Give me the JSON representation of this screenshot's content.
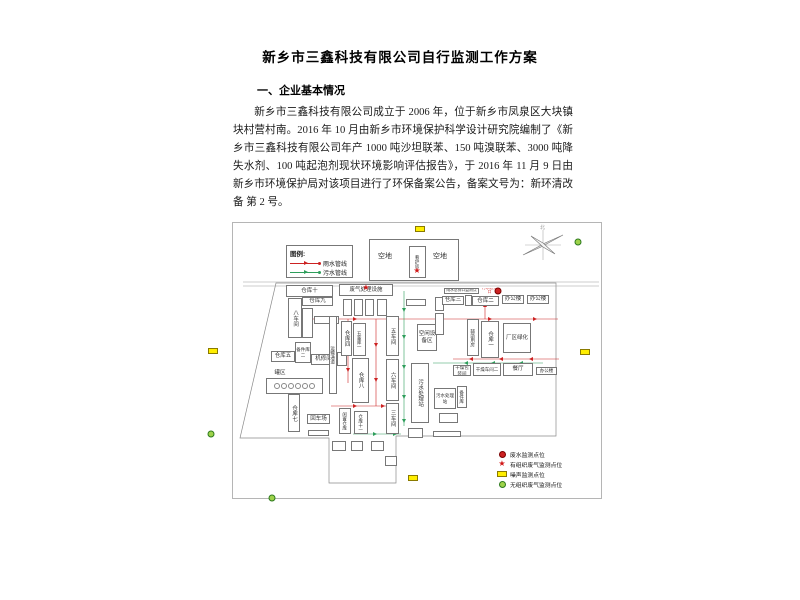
{
  "document": {
    "title": "新乡市三鑫科技有限公司自行监测工作方案",
    "section1_heading": "一、企业基本情况",
    "section1_paragraph": "新乡市三鑫科技有限公司成立于 2006 年，位于新乡市凤泉区大块镇块村营村南。2016 年 10 月由新乡市环境保护科学设计研究院编制了《新乡市三鑫科技有限公司年产 1000 吨沙坦联苯、150 吨溴联苯、3000 吨降失水剂、100 吨起泡剂现状环境影响评估报告》，于 2016 年 11 月 9 日由新乡市环境保护局对该项目进行了环保备案公告，备案文号为：新环清改备 第 2 号。",
    "section2_heading": "二、监测点位及示意图"
  },
  "diagram": {
    "compass_label": "北",
    "colors": {
      "rain": "#cc2222",
      "sewage": "#2e9e5b",
      "noise_fill": "#ffee00",
      "gas_green": "#9ed24a"
    },
    "legend_pipes": {
      "title": "图例:",
      "items": [
        {
          "label": "雨水管线",
          "color": "#cc2222"
        },
        {
          "label": "污水管线",
          "color": "#2e9e5b"
        }
      ]
    },
    "legend_points": {
      "items": [
        {
          "label": "废水监测点位",
          "symbol": "red-dot"
        },
        {
          "label": "有组织废气监测点位",
          "symbol": "red-star"
        },
        {
          "label": "噪声监测点位",
          "symbol": "yellow-rect"
        },
        {
          "label": "无组织废气监测点位",
          "symbol": "green-circle"
        }
      ]
    },
    "open_area": {
      "label_left": "空地",
      "label_right": "空地",
      "guard_room": "看护房"
    },
    "buildings": [
      {
        "l": "",
        "x": 136,
        "y": 16,
        "w": 90,
        "h": 42
      },
      {
        "l": "空地",
        "x": 142,
        "y": 28,
        "w": 20,
        "h": 12,
        "nb": 1,
        "big": 1
      },
      {
        "l": "空地",
        "x": 197,
        "y": 28,
        "w": 20,
        "h": 12,
        "nb": 1,
        "big": 1
      },
      {
        "l": "看护房",
        "x": 176,
        "y": 23,
        "w": 17,
        "h": 32,
        "v": 1,
        "small": 1
      },
      {
        "l": "仓库十",
        "x": 53,
        "y": 62,
        "w": 47,
        "h": 12
      },
      {
        "l": "仓库九",
        "x": 69,
        "y": 74,
        "w": 31,
        "h": 9
      },
      {
        "l": "八车间",
        "x": 55,
        "y": 75,
        "w": 14,
        "h": 40,
        "v": 1
      },
      {
        "l": "",
        "x": 69,
        "y": 85,
        "w": 11,
        "h": 30,
        "v": 1
      },
      {
        "l": "",
        "x": 81,
        "y": 93,
        "w": 25,
        "h": 8
      },
      {
        "l": "仓库五",
        "x": 38,
        "y": 128,
        "w": 24,
        "h": 11
      },
      {
        "l": "备件库二",
        "x": 62,
        "y": 119,
        "w": 16,
        "h": 21,
        "small": 1
      },
      {
        "l": "机修间",
        "x": 78,
        "y": 131,
        "w": 25,
        "h": 11
      },
      {
        "l": "",
        "x": 104,
        "y": 129,
        "w": 10,
        "h": 14
      },
      {
        "l": "罐区",
        "x": 38,
        "y": 146,
        "w": 18,
        "h": 8,
        "nb": 1
      },
      {
        "l": "",
        "x": 33,
        "y": 155,
        "w": 57,
        "h": 16,
        "tank": 1
      },
      {
        "l": "仓库七",
        "x": 55,
        "y": 171,
        "w": 12,
        "h": 38,
        "v": 1
      },
      {
        "l": "回车场",
        "x": 74,
        "y": 191,
        "w": 23,
        "h": 10
      },
      {
        "l": "",
        "x": 75,
        "y": 207,
        "w": 21,
        "h": 6
      },
      {
        "l": "运输通道",
        "x": 96,
        "y": 93,
        "w": 8,
        "h": 78,
        "v": 1,
        "small": 1
      },
      {
        "l": "废气处理设施",
        "x": 106,
        "y": 61,
        "w": 54,
        "h": 12
      },
      {
        "l": "",
        "x": 110,
        "y": 76,
        "w": 9,
        "h": 17
      },
      {
        "l": "",
        "x": 121,
        "y": 76,
        "w": 9,
        "h": 17
      },
      {
        "l": "",
        "x": 132,
        "y": 76,
        "w": 9,
        "h": 17
      },
      {
        "l": "",
        "x": 144,
        "y": 76,
        "w": 10,
        "h": 17
      },
      {
        "l": "仓库四",
        "x": 108,
        "y": 98,
        "w": 11,
        "h": 35,
        "v": 1
      },
      {
        "l": "五金库一",
        "x": 120,
        "y": 100,
        "w": 13,
        "h": 33,
        "v": 1,
        "small": 1
      },
      {
        "l": "五车间",
        "x": 153,
        "y": 93,
        "w": 13,
        "h": 40,
        "v": 1
      },
      {
        "l": "六车间",
        "x": 153,
        "y": 136,
        "w": 13,
        "h": 42,
        "v": 1
      },
      {
        "l": "三车间",
        "x": 153,
        "y": 180,
        "w": 13,
        "h": 31,
        "v": 1
      },
      {
        "l": "仓库八",
        "x": 119,
        "y": 135,
        "w": 17,
        "h": 45,
        "v": 1
      },
      {
        "l": "闲置仓库",
        "x": 106,
        "y": 185,
        "w": 12,
        "h": 26,
        "v": 1,
        "small": 1
      },
      {
        "l": "仓库十一",
        "x": 121,
        "y": 188,
        "w": 14,
        "h": 23,
        "v": 1,
        "small": 1
      },
      {
        "l": "污水处理站",
        "x": 178,
        "y": 140,
        "w": 18,
        "h": 60,
        "v": 1
      },
      {
        "l": "空闲设备区",
        "x": 184,
        "y": 101,
        "w": 20,
        "h": 27
      },
      {
        "l": "",
        "x": 173,
        "y": 76,
        "w": 20,
        "h": 7
      },
      {
        "l": "",
        "x": 202,
        "y": 74,
        "w": 9,
        "h": 14,
        "v": 1
      },
      {
        "l": "",
        "x": 202,
        "y": 90,
        "w": 9,
        "h": 22,
        "v": 1
      },
      {
        "l": "",
        "x": 99,
        "y": 218,
        "w": 14,
        "h": 10
      },
      {
        "l": "",
        "x": 118,
        "y": 218,
        "w": 12,
        "h": 10
      },
      {
        "l": "",
        "x": 138,
        "y": 218,
        "w": 13,
        "h": 10
      },
      {
        "l": "",
        "x": 152,
        "y": 233,
        "w": 12,
        "h": 10
      },
      {
        "l": "",
        "x": 175,
        "y": 205,
        "w": 15,
        "h": 10
      },
      {
        "l": "",
        "x": 206,
        "y": 190,
        "w": 19,
        "h": 10
      },
      {
        "l": "",
        "x": 200,
        "y": 208,
        "w": 28,
        "h": 6
      },
      {
        "l": "仓库三",
        "x": 209,
        "y": 73,
        "w": 22,
        "h": 9
      },
      {
        "l": "",
        "x": 232,
        "y": 72,
        "w": 7,
        "h": 11
      },
      {
        "l": "仓库二",
        "x": 239,
        "y": 73,
        "w": 27,
        "h": 10
      },
      {
        "l": "办公楼",
        "x": 269,
        "y": 72,
        "w": 22,
        "h": 9
      },
      {
        "l": "办公楼",
        "x": 294,
        "y": 72,
        "w": 22,
        "h": 9
      },
      {
        "l": "辅助用房",
        "x": 234,
        "y": 96,
        "w": 12,
        "h": 37,
        "v": 1,
        "small": 1
      },
      {
        "l": "仓库一",
        "x": 248,
        "y": 98,
        "w": 18,
        "h": 37,
        "v": 1
      },
      {
        "l": "厂区绿化",
        "x": 270,
        "y": 100,
        "w": 28,
        "h": 30
      },
      {
        "l": "干燥包装间",
        "x": 220,
        "y": 142,
        "w": 18,
        "h": 11,
        "small": 1
      },
      {
        "l": "干燥车间二",
        "x": 240,
        "y": 140,
        "w": 28,
        "h": 13,
        "small": 1
      },
      {
        "l": "餐厅",
        "x": 270,
        "y": 140,
        "w": 30,
        "h": 13
      },
      {
        "l": "办公楼",
        "x": 303,
        "y": 144,
        "w": 21,
        "h": 8,
        "small": 1
      },
      {
        "l": "污水处理站",
        "x": 201,
        "y": 165,
        "w": 22,
        "h": 21,
        "small": 1
      },
      {
        "l": "备件库",
        "x": 224,
        "y": 163,
        "w": 10,
        "h": 22,
        "v": 1,
        "small": 1
      },
      {
        "l": "雨水总排口监测点",
        "x": 211,
        "y": 65,
        "w": 35,
        "h": 6,
        "micro": 1
      },
      {
        "l": "污水总排口",
        "x": 248,
        "y": 65,
        "w": 17,
        "h": 6,
        "micro": 1,
        "red": 1,
        "nb": 1
      }
    ],
    "boundary_points": "43,60 323,60 323,213 163,213 163,260 96,260 96,215 7,215",
    "roads": [
      [
        10,
        59,
        366,
        59
      ],
      [
        10,
        63,
        366,
        63
      ]
    ],
    "pipes": [
      {
        "c": "#cc2222",
        "pts": [
          68,
          96,
          325,
          96
        ],
        "arrows": [
          [
            90,
            96,
            "r"
          ],
          [
            120,
            96,
            "r"
          ],
          [
            155,
            96,
            "r"
          ],
          [
            205,
            96,
            "r"
          ],
          [
            255,
            96,
            "r"
          ],
          [
            300,
            96,
            "r"
          ]
        ]
      },
      {
        "c": "#cc2222",
        "pts": [
          115,
          96,
          115,
          160
        ],
        "arrows": [
          [
            115,
            118,
            "d"
          ],
          [
            115,
            145,
            "d"
          ]
        ]
      },
      {
        "c": "#cc2222",
        "pts": [
          143,
          96,
          143,
          183
        ],
        "arrows": [
          [
            143,
            120,
            "d"
          ],
          [
            143,
            155,
            "d"
          ]
        ]
      },
      {
        "c": "#cc2222",
        "pts": [
          98,
          183,
          160,
          183
        ],
        "arrows": [
          [
            120,
            183,
            "r"
          ],
          [
            148,
            183,
            "r"
          ]
        ]
      },
      {
        "c": "#cc2222",
        "pts": [
          220,
          136,
          326,
          136
        ],
        "arrows": [
          [
            240,
            136,
            "l"
          ],
          [
            270,
            136,
            "l"
          ],
          [
            300,
            136,
            "l"
          ]
        ]
      },
      {
        "c": "#cc2222",
        "pts": [
          252,
          74,
          252,
          96
        ],
        "arrows": [
          [
            252,
            84,
            "u"
          ]
        ]
      },
      {
        "c": "#2e9e5b",
        "pts": [
          171,
          68,
          171,
          203
        ],
        "arrows": [
          [
            171,
            85,
            "d"
          ],
          [
            171,
            112,
            "d"
          ],
          [
            171,
            142,
            "d"
          ],
          [
            171,
            172,
            "d"
          ],
          [
            171,
            196,
            "d"
          ]
        ]
      },
      {
        "c": "#2e9e5b",
        "pts": [
          200,
          140,
          310,
          140
        ],
        "arrows": [
          [
            235,
            140,
            "l"
          ],
          [
            262,
            140,
            "l"
          ],
          [
            290,
            140,
            "l"
          ]
        ]
      },
      {
        "c": "#2e9e5b",
        "pts": [
          120,
          211,
          168,
          211
        ],
        "arrows": [
          [
            140,
            211,
            "r"
          ],
          [
            160,
            211,
            "r"
          ]
        ]
      }
    ],
    "markers": [
      {
        "t": "red-star",
        "x": 417,
        "y": 271
      },
      {
        "t": "red-star",
        "x": 366,
        "y": 288
      },
      {
        "t": "red-dot",
        "x": 498,
        "y": 291
      },
      {
        "t": "yellow-rect",
        "x": 420,
        "y": 229
      },
      {
        "t": "yellow-rect",
        "x": 213,
        "y": 351
      },
      {
        "t": "yellow-rect",
        "x": 585,
        "y": 352
      },
      {
        "t": "yellow-rect",
        "x": 413,
        "y": 478
      },
      {
        "t": "green-circle",
        "x": 578,
        "y": 242
      },
      {
        "t": "green-circle",
        "x": 211,
        "y": 434
      },
      {
        "t": "green-circle",
        "x": 272,
        "y": 498
      }
    ]
  }
}
